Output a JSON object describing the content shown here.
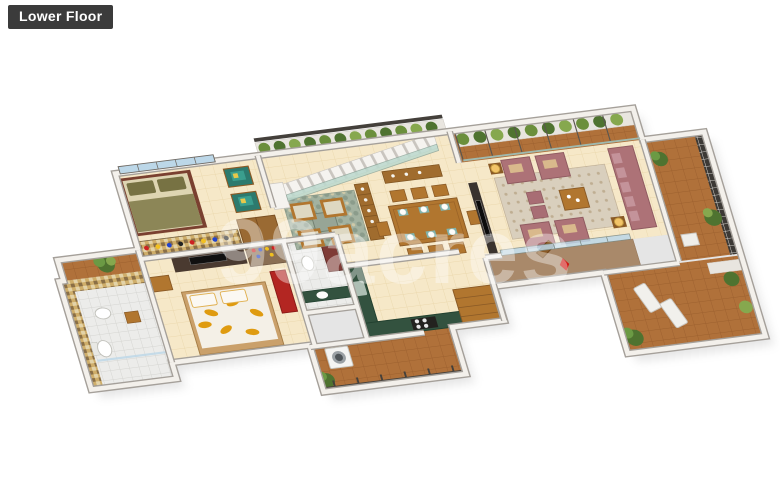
{
  "floor_label": {
    "text": "Lower Floor",
    "bg": "#3b3b3b",
    "color": "#ffffff"
  },
  "watermark": {
    "text": "99acres",
    "color": "#ffffff"
  },
  "scene": {
    "type": "isometric-3d-floor-plan",
    "view": "cutaway axonometric render on white background",
    "palette": {
      "wall_face": "#f3f0eb",
      "wall_edge": "#a5a09a",
      "floor_tile_cream": "#f6e8c8",
      "balcony_terracotta": "#b0713a",
      "bathroom_tile": "#ececea",
      "mosaic_wall": "#cfae6a",
      "kitchen_granite": "#33523f",
      "sofa_mauve": "#ad7277",
      "accent_chair_teal": "#2c7a6e",
      "wood": "#b1762f",
      "dark_console": "#4a3a30",
      "rug_living": "#d9cfbd",
      "rug_lounge": "#a3b2a0",
      "plant_green": "#4f7330",
      "glass_blue": "#bcd7e8",
      "stair_glass": "#bcd9ce",
      "red_accent": "#c01f1a",
      "duvet_leaf": "#df9b10",
      "foyer_marble": "#a9896a",
      "railing_dark": "#44403b",
      "olive_bedding": "#8c8657",
      "lamp_shade": "#f2c468"
    },
    "rooms": [
      {
        "name": "master-bedroom",
        "floor": "cream-tile",
        "furniture": [
          "double-bed-olive",
          "teal-armchairs",
          "shoe-rack-mosaic-wall",
          "wardrobe",
          "window-band"
        ]
      },
      {
        "name": "bedroom-2",
        "floor": "cream-tile",
        "furniture": [
          "leaf-pattern-bed",
          "tv-console",
          "dresser-with-bottles",
          "red-bench",
          "wooden-chair"
        ]
      },
      {
        "name": "bathroom-1",
        "floor": "white-tile",
        "furniture": [
          "toilet",
          "washbasin",
          "shower-glass",
          "mosaic-walls"
        ]
      },
      {
        "name": "plant-atrium",
        "floor": "terracotta-tile",
        "furniture": [
          "plant",
          "railing"
        ]
      },
      {
        "name": "bathroom-2",
        "floor": "white-tile",
        "furniture": [
          "toilet",
          "green-counter-basin",
          "maroon-cabinet"
        ]
      },
      {
        "name": "lounge-seating",
        "floor": "cream-tile",
        "furniture": [
          "four-cream-chairs",
          "pebble-rug",
          "stone-table",
          "bookshelf"
        ]
      },
      {
        "name": "staircase",
        "floor": "white-steps",
        "furniture": [
          "glass-balustrade",
          "hedge-planter",
          "balcony-railing"
        ]
      },
      {
        "name": "dining-room",
        "floor": "cream-tile",
        "furniture": [
          "eight-seat-dining-table",
          "plates",
          "teal-placemats",
          "sideboard"
        ]
      },
      {
        "name": "living-room",
        "floor": "cream-tile",
        "furniture": [
          "mauve-sofa-set",
          "ottomans",
          "coffee-table",
          "table-lamps",
          "tv-panel",
          "rug",
          "glass-sliding-doors"
        ]
      },
      {
        "name": "entrance-foyer",
        "floor": "brown-marble",
        "furniture": [
          "open-wooden-door",
          "red-ornament"
        ]
      },
      {
        "name": "kitchen",
        "floor": "cream-tile",
        "furniture": [
          "green-granite-l-counter",
          "four-burner-hob",
          "sink",
          "wooden-steps"
        ]
      },
      {
        "name": "utility-balcony",
        "floor": "terracotta-tile",
        "furniture": [
          "washing-machine",
          "plant",
          "dark-railing"
        ]
      },
      {
        "name": "rear-terrace",
        "floor": "terracotta-tile",
        "furniture": [
          "hedge-planters",
          "glass-wall-posts"
        ]
      },
      {
        "name": "side-balcony",
        "floor": "terracotta-tile",
        "furniture": [
          "dark-trellis",
          "plants",
          "white-chair"
        ]
      },
      {
        "name": "front-terrace",
        "floor": "terracotta-tile",
        "furniture": [
          "two-white-loungers",
          "plants",
          "railing"
        ]
      }
    ]
  }
}
